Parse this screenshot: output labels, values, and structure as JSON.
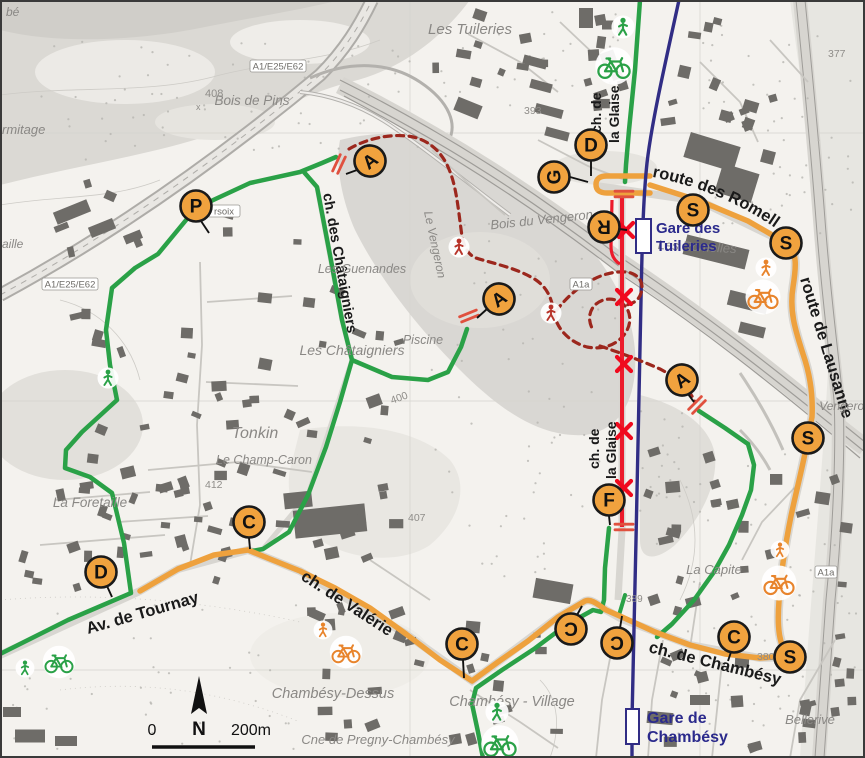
{
  "map": {
    "title": "Chambésy / Les Tuileries route map",
    "colors": {
      "route_orange": "#EEA13D",
      "route_green": "#2AA147",
      "route_closed_red": "#EC1B2B",
      "route_diversion_darkred": "#9C271D",
      "railway_navy": "#312D85",
      "marker_fill": "#F0A23E",
      "station_blue": "#2B2A8C",
      "icon_orange": "#E8842C",
      "icon_green": "#2AA147",
      "icon_darkred": "#B8342A"
    },
    "street_labels": [
      {
        "text": "route de Lausanne",
        "x": 800,
        "y": 279,
        "rot": 73,
        "size": 16.5
      },
      {
        "text": "Av. de Tournay",
        "x": 88,
        "y": 634,
        "rot": -16,
        "size": 16.5
      },
      {
        "text": "ch. de Valérie",
        "x": 300,
        "y": 579,
        "rot": 33,
        "size": 16.5
      },
      {
        "text": "ch. de Chambésy",
        "x": 648,
        "y": 652,
        "rot": 14,
        "size": 16.5
      },
      {
        "text": "ch. des Châtaigniers",
        "x": 323,
        "y": 194,
        "rot": 80,
        "size": 14.5
      },
      {
        "text": "ch. de",
        "x": 601,
        "y": 133,
        "rot": -90,
        "size": 14
      },
      {
        "text": "la Glaise",
        "x": 619,
        "y": 143,
        "rot": -90,
        "size": 14
      },
      {
        "text": "ch. de",
        "x": 599,
        "y": 469,
        "rot": -90,
        "size": 14
      },
      {
        "text": "la Glaise",
        "x": 616,
        "y": 479,
        "rot": -90,
        "size": 14
      }
    ],
    "curved_street_label": {
      "text": "route des Romelles",
      "size": 16.5
    },
    "place_labels": [
      {
        "text": "bé",
        "x": 6,
        "y": 16,
        "size": 12
      },
      {
        "text": "rmitage",
        "x": 2,
        "y": 134,
        "size": 13
      },
      {
        "text": "aille",
        "x": 2,
        "y": 248,
        "size": 12
      },
      {
        "text": "Bois de Pins",
        "x": 252,
        "y": 105,
        "size": 13.5,
        "anchor": "middle"
      },
      {
        "text": "Les Tuileries",
        "x": 470,
        "y": 34,
        "size": 15,
        "anchor": "middle"
      },
      {
        "text": "Bois du Vengeron",
        "x": 542,
        "y": 224,
        "size": 13,
        "rot": -6,
        "anchor": "middle"
      },
      {
        "text": "Le Vengeron",
        "x": 424,
        "y": 212,
        "size": 12,
        "rot": 78,
        "color": "#8F959E"
      },
      {
        "text": "Les Romelles",
        "x": 697,
        "y": 251,
        "size": 13,
        "rot": 3,
        "anchor": "middle"
      },
      {
        "text": "Les Guenandes",
        "x": 362,
        "y": 273,
        "size": 12.5,
        "anchor": "middle"
      },
      {
        "text": "Les Châtaigniers",
        "x": 352,
        "y": 355,
        "size": 14,
        "anchor": "middle"
      },
      {
        "text": "Piscine",
        "x": 423,
        "y": 344,
        "size": 12.5,
        "anchor": "middle"
      },
      {
        "text": "Tonkin",
        "x": 255,
        "y": 438,
        "size": 16,
        "anchor": "middle"
      },
      {
        "text": "Le Champ-Caron",
        "x": 264,
        "y": 464,
        "size": 12.5,
        "anchor": "middle"
      },
      {
        "text": "La Foretaille",
        "x": 90,
        "y": 507,
        "size": 13.5,
        "anchor": "middle"
      },
      {
        "text": "Chambésy-Dessus",
        "x": 333,
        "y": 698,
        "size": 14.5,
        "anchor": "middle"
      },
      {
        "text": "Chambésy - Village",
        "x": 512,
        "y": 706,
        "size": 14.5,
        "anchor": "middle"
      },
      {
        "text": "Cne de Pregny-Chambésy",
        "x": 378,
        "y": 744,
        "size": 13,
        "anchor": "middle"
      },
      {
        "text": "La Capite",
        "x": 714,
        "y": 574,
        "size": 13,
        "anchor": "middle"
      },
      {
        "text": "Bellerive",
        "x": 810,
        "y": 724,
        "size": 13,
        "anchor": "middle"
      },
      {
        "text": "Vengeron",
        "x": 845,
        "y": 410,
        "size": 12,
        "anchor": "middle"
      }
    ],
    "elevation_labels": [
      {
        "text": "408",
        "x": 205,
        "y": 97,
        "size": 11
      },
      {
        "text": "x",
        "x": 196,
        "y": 110,
        "size": 9
      },
      {
        "text": "393",
        "x": 524,
        "y": 114,
        "size": 10.5
      },
      {
        "text": "377",
        "x": 828,
        "y": 57,
        "size": 10.5
      },
      {
        "text": "400",
        "x": 392,
        "y": 404,
        "size": 10.5,
        "rot": -20
      },
      {
        "text": "407",
        "x": 408,
        "y": 521,
        "size": 10.5
      },
      {
        "text": "412",
        "x": 205,
        "y": 488,
        "size": 10.5
      },
      {
        "text": "389",
        "x": 626,
        "y": 602,
        "size": 10
      },
      {
        "text": "380",
        "x": 757,
        "y": 660,
        "size": 10.5
      }
    ],
    "road_signs": [
      {
        "text": "A1/E25/E62",
        "x": 278,
        "y": 66,
        "w": 56
      },
      {
        "text": "A1/E25/E62",
        "x": 70,
        "y": 284,
        "w": 56
      },
      {
        "text": "A1a",
        "x": 581,
        "y": 284,
        "w": 22
      },
      {
        "text": "A1a",
        "x": 826,
        "y": 572,
        "w": 22
      },
      {
        "text": "rsoix",
        "x": 224,
        "y": 211,
        "w": 32
      }
    ],
    "stations": [
      {
        "line1": "Gare des",
        "line2": "Tuileries",
        "tx": 656,
        "ty1": 233,
        "ty2": 251,
        "rx": 636,
        "ry": 219,
        "rw": 15,
        "rh": 34,
        "size": 15
      },
      {
        "line1": "Gare de",
        "line2": "Chambésy",
        "tx": 647,
        "ty1": 723,
        "ty2": 742,
        "rx": 626,
        "ry": 709,
        "rw": 13,
        "rh": 35,
        "size": 16
      }
    ],
    "markers": [
      {
        "letter": "P",
        "x": 196,
        "y": 206,
        "rot": 0,
        "leader": [
          201,
          221,
          209,
          233
        ]
      },
      {
        "letter": "A",
        "x": 370,
        "y": 161,
        "rot": -38,
        "leader": [
          357,
          170,
          346,
          174
        ]
      },
      {
        "letter": "A",
        "x": 499,
        "y": 299,
        "rot": -35,
        "leader": [
          487,
          309,
          477,
          318
        ]
      },
      {
        "letter": "A",
        "x": 682,
        "y": 380,
        "rot": -35,
        "leader": [
          688,
          394,
          694,
          402
        ]
      },
      {
        "letter": "G",
        "x": 554,
        "y": 177,
        "rot": -90,
        "leader": [
          570,
          177,
          588,
          182
        ]
      },
      {
        "letter": "D",
        "x": 591,
        "y": 145,
        "rot": 0,
        "leader": [
          591,
          161,
          591,
          176
        ]
      },
      {
        "letter": "R",
        "x": 604,
        "y": 227,
        "rot": 180,
        "leader": [
          619,
          229,
          627,
          230
        ]
      },
      {
        "letter": "S",
        "x": 693,
        "y": 210,
        "rot": 0
      },
      {
        "letter": "S",
        "x": 786,
        "y": 243,
        "rot": 0
      },
      {
        "letter": "S",
        "x": 808,
        "y": 438,
        "rot": 0
      },
      {
        "letter": "F",
        "x": 609,
        "y": 500,
        "rot": 0,
        "leader": [
          609,
          516,
          610,
          525
        ]
      },
      {
        "letter": "C",
        "x": 249,
        "y": 522,
        "rot": 0,
        "leader": [
          249,
          538,
          250,
          549
        ]
      },
      {
        "letter": "D",
        "x": 101,
        "y": 572,
        "rot": 0,
        "leader": [
          107,
          586,
          112,
          597
        ]
      },
      {
        "letter": "C",
        "x": 462,
        "y": 644,
        "rot": 0,
        "leader": [
          463,
          660,
          464,
          678
        ]
      },
      {
        "letter": "C",
        "x": 571,
        "y": 629,
        "rot": 180,
        "leader": [
          577,
          615,
          582,
          606
        ]
      },
      {
        "letter": "C",
        "x": 617,
        "y": 643,
        "rot": 180,
        "leader": [
          620,
          628,
          622,
          616
        ]
      },
      {
        "letter": "C",
        "x": 734,
        "y": 637,
        "rot": 0,
        "leader": [
          731,
          652,
          728,
          661
        ]
      },
      {
        "letter": "S",
        "x": 790,
        "y": 657,
        "rot": 0
      }
    ],
    "icons": [
      {
        "kind": "pedestrian",
        "color": "green",
        "x": 623,
        "y": 27,
        "s": 1.1
      },
      {
        "kind": "bicycle",
        "color": "green",
        "x": 614,
        "y": 66,
        "s": 1.5
      },
      {
        "kind": "pedestrian",
        "color": "green",
        "x": 108,
        "y": 378,
        "s": 1.0
      },
      {
        "kind": "pedestrian",
        "color": "darkred",
        "x": 459,
        "y": 247,
        "s": 1.0
      },
      {
        "kind": "pedestrian",
        "color": "darkred",
        "x": 551,
        "y": 313,
        "s": 1.0
      },
      {
        "kind": "pedestrian",
        "color": "orange",
        "x": 766,
        "y": 268,
        "s": 1.0
      },
      {
        "kind": "bicycle",
        "color": "orange",
        "x": 763,
        "y": 297,
        "s": 1.4
      },
      {
        "kind": "pedestrian",
        "color": "orange",
        "x": 323,
        "y": 630,
        "s": 0.9
      },
      {
        "kind": "bicycle",
        "color": "orange",
        "x": 346,
        "y": 652,
        "s": 1.3
      },
      {
        "kind": "pedestrian",
        "color": "orange",
        "x": 780,
        "y": 550,
        "s": 0.9
      },
      {
        "kind": "bicycle",
        "color": "orange",
        "x": 779,
        "y": 583,
        "s": 1.4
      },
      {
        "kind": "pedestrian",
        "color": "green",
        "x": 497,
        "y": 712,
        "s": 1.1
      },
      {
        "kind": "bicycle",
        "color": "green",
        "x": 500,
        "y": 744,
        "s": 1.5
      },
      {
        "kind": "pedestrian",
        "color": "green",
        "x": 25,
        "y": 668,
        "s": 0.9
      },
      {
        "kind": "bicycle",
        "color": "green",
        "x": 59,
        "y": 662,
        "s": 1.3
      }
    ],
    "closure_x_marks": [
      {
        "x": 626,
        "y": 230
      },
      {
        "x": 624,
        "y": 297
      },
      {
        "x": 624,
        "y": 364
      },
      {
        "x": 624,
        "y": 431
      },
      {
        "x": 624,
        "y": 488
      }
    ],
    "closure_barriers": [
      {
        "x": 339,
        "y": 164,
        "rot": -65
      },
      {
        "x": 469,
        "y": 316,
        "rot": -22
      },
      {
        "x": 697,
        "y": 405,
        "rot": -45
      },
      {
        "x": 624,
        "y": 194,
        "rot": 0
      },
      {
        "x": 624,
        "y": 527,
        "rot": 0
      }
    ],
    "scale_bar": {
      "zero": "0",
      "distance": "200m",
      "north": "N"
    }
  }
}
